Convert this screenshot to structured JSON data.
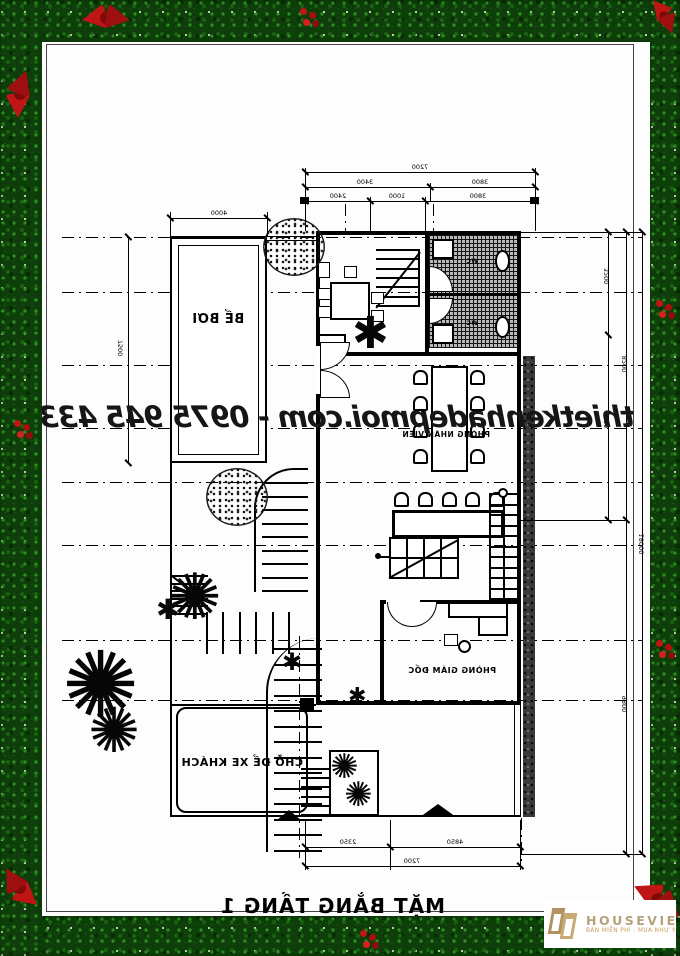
{
  "watermark": "thietkenhadepmoi.com - 0975 945 433",
  "plan_title": "MẶT BẰNG TẦNG 1",
  "labels": {
    "pool": "BỂ BƠI",
    "staff_room": "PHÒNG NHÂN VIÊN",
    "director_room": "PHÒNG GIÁM ĐỐC",
    "guest_parking": "CHỖ ĐỂ XE KHÁCH",
    "wc": "WC"
  },
  "dimensions": {
    "top_total": "7200",
    "top_mid": [
      "3400",
      "3800"
    ],
    "top_inner": [
      "2400",
      "1000",
      "3800"
    ],
    "pool_top": "4000",
    "left_side": "7500",
    "right_inner": [
      "3200",
      "5000"
    ],
    "right_mid": [
      "8200",
      "9800"
    ],
    "right_total": "18000",
    "bottom_inner": [
      "2350",
      "4850"
    ],
    "bottom_total": "7200"
  },
  "logo": {
    "name": "HOUSEVIET",
    "tagline": "BÁN MIỄN PHÍ - MUA NHƯ Ý"
  },
  "icons": {
    "palm": "✺",
    "shrub": "✱"
  },
  "colors": {
    "garland_green": "#0e3f0a",
    "bow_red": "#bf1515",
    "logo_gold": "#b29260",
    "ink": "#000000"
  }
}
